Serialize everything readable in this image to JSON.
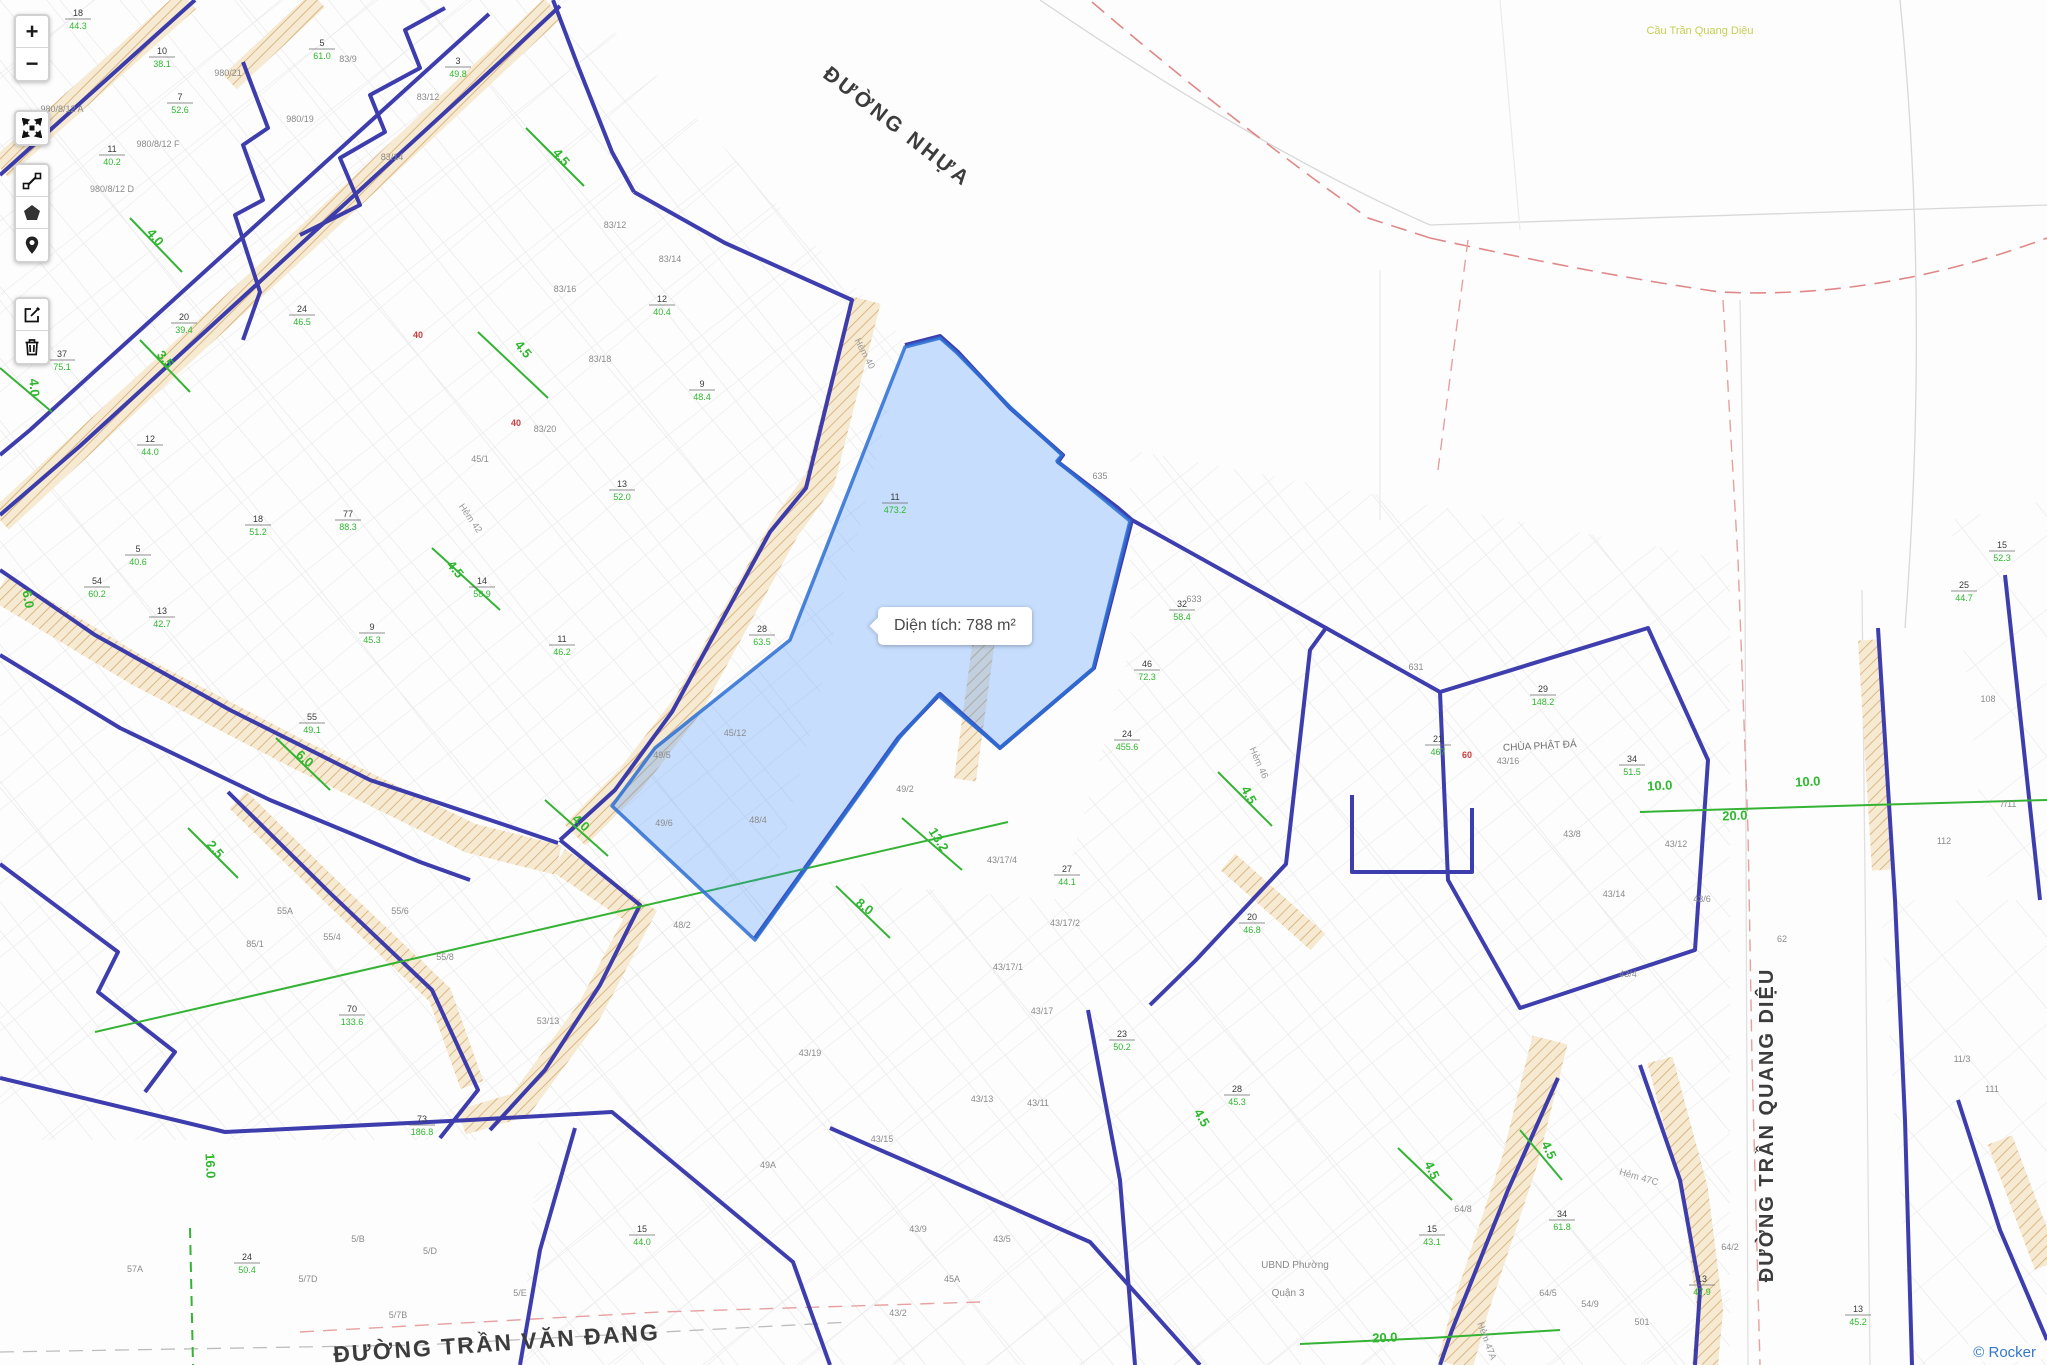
{
  "attribution": {
    "label": "© Rocker"
  },
  "toolbar": {
    "zoom_in": "+",
    "zoom_out": "−",
    "tools": [
      "fullscreen",
      "measure",
      "polygon",
      "marker",
      "edit",
      "delete"
    ]
  },
  "tooltip": {
    "text": "Diện tích: 788 m²"
  },
  "colors": {
    "boundary_navy": "#2f2fa8",
    "selection_fill": "#3388ff",
    "selection_stroke": "#2b6fd4",
    "dimension_green": "#2eb82e",
    "road_hatch_tan": "#d7b27e",
    "red_dashed": "#e08888",
    "attribution_blue": "#3478c8"
  },
  "map": {
    "streets": [
      {
        "t": "ĐƯỜNG NHỰA",
        "x": 893,
        "y": 132,
        "r": 38,
        "s": 21,
        "ls": 3
      },
      {
        "t": "ĐƯỜNG TRẦN QUANG DIỆU",
        "x": 1773,
        "y": 1125,
        "r": -90,
        "s": 20,
        "ls": 2
      },
      {
        "t": "ĐƯỜNG TRẦN VĂN ĐANG",
        "x": 497,
        "y": 1351,
        "r": -4,
        "s": 23,
        "ls": 2
      }
    ],
    "poi": [
      {
        "t": "Cầu Trần Quang Diệu",
        "x": 1700,
        "y": 34,
        "s": 11,
        "c": "#c6cf52"
      },
      {
        "t": "CHÙA PHẬT ĐÁ",
        "x": 1540,
        "y": 749,
        "s": 10,
        "c": "#6f6f6f",
        "r": -3
      },
      {
        "t": "UBND Phường",
        "x": 1295,
        "y": 1268,
        "s": 10,
        "c": "#8a8a8a"
      },
      {
        "t": "Quận 3",
        "x": 1288,
        "y": 1296,
        "s": 10,
        "c": "#8a8a8a"
      }
    ],
    "hems": [
      {
        "t": "Hẻm 40",
        "x": 862,
        "y": 355,
        "r": 62
      },
      {
        "t": "Hẻm 46",
        "x": 1256,
        "y": 764,
        "r": 66
      },
      {
        "t": "Hẻm 47C",
        "x": 1638,
        "y": 1180,
        "r": 16
      },
      {
        "t": "Hẻm 47A",
        "x": 1484,
        "y": 1342,
        "r": 70
      },
      {
        "t": "Hẻm 42",
        "x": 468,
        "y": 520,
        "r": 55
      }
    ],
    "dims": [
      {
        "t": "4.5",
        "x": 558,
        "y": 160,
        "r": 50
      },
      {
        "t": "4.5",
        "x": 520,
        "y": 352,
        "r": 50
      },
      {
        "t": "4.5",
        "x": 452,
        "y": 572,
        "r": 50
      },
      {
        "t": "4.0",
        "x": 152,
        "y": 240,
        "r": 50
      },
      {
        "t": "4.0",
        "x": 30,
        "y": 388,
        "r": 85
      },
      {
        "t": "4.0",
        "x": 578,
        "y": 826,
        "r": 42
      },
      {
        "t": "3.5",
        "x": 162,
        "y": 362,
        "r": 50
      },
      {
        "t": "6.0",
        "x": 24,
        "y": 600,
        "r": 80
      },
      {
        "t": "6.0",
        "x": 302,
        "y": 762,
        "r": 40
      },
      {
        "t": "2.5",
        "x": 212,
        "y": 852,
        "r": 50
      },
      {
        "t": "8.0",
        "x": 862,
        "y": 910,
        "r": 38
      },
      {
        "t": "13.2",
        "x": 935,
        "y": 842,
        "r": 58
      },
      {
        "t": "16.0",
        "x": 206,
        "y": 1166,
        "r": 87
      },
      {
        "t": "10.0",
        "x": 1660,
        "y": 790,
        "r": -3
      },
      {
        "t": "20.0",
        "x": 1735,
        "y": 820,
        "r": -2
      },
      {
        "t": "10.0",
        "x": 1808,
        "y": 786,
        "r": -3
      },
      {
        "t": "20.0",
        "x": 1385,
        "y": 1342,
        "r": -2
      },
      {
        "t": "4.5",
        "x": 1245,
        "y": 797,
        "r": 62
      },
      {
        "t": "4.5",
        "x": 1428,
        "y": 1172,
        "r": 65
      },
      {
        "t": "4.5",
        "x": 1198,
        "y": 1120,
        "r": 60
      },
      {
        "t": "4.5",
        "x": 1545,
        "y": 1152,
        "r": 65
      }
    ],
    "fractions": [
      {
        "x": 78,
        "y": 16,
        "a": "18",
        "b": "44.3"
      },
      {
        "x": 162,
        "y": 54,
        "a": "10",
        "b": "38.1"
      },
      {
        "x": 180,
        "y": 100,
        "a": "7",
        "b": "52.6"
      },
      {
        "x": 112,
        "y": 152,
        "a": "11",
        "b": "40.2"
      },
      {
        "x": 322,
        "y": 46,
        "a": "5",
        "b": "61.0"
      },
      {
        "x": 458,
        "y": 64,
        "a": "3",
        "b": "49.8"
      },
      {
        "x": 302,
        "y": 312,
        "a": "24",
        "b": "46.5"
      },
      {
        "x": 184,
        "y": 320,
        "a": "20",
        "b": "39.4"
      },
      {
        "x": 62,
        "y": 357,
        "a": "37",
        "b": "75.1"
      },
      {
        "x": 150,
        "y": 442,
        "a": "12",
        "b": "44.0"
      },
      {
        "x": 258,
        "y": 522,
        "a": "18",
        "b": "51.2"
      },
      {
        "x": 138,
        "y": 552,
        "a": "5",
        "b": "40.6"
      },
      {
        "x": 348,
        "y": 517,
        "a": "77",
        "b": "88.3"
      },
      {
        "x": 97,
        "y": 584,
        "a": "54",
        "b": "60.2"
      },
      {
        "x": 162,
        "y": 614,
        "a": "13",
        "b": "42.7"
      },
      {
        "x": 372,
        "y": 630,
        "a": "9",
        "b": "45.3"
      },
      {
        "x": 482,
        "y": 584,
        "a": "14",
        "b": "58.9"
      },
      {
        "x": 312,
        "y": 720,
        "a": "55",
        "b": "49.1"
      },
      {
        "x": 662,
        "y": 302,
        "a": "12",
        "b": "40.4"
      },
      {
        "x": 702,
        "y": 387,
        "a": "9",
        "b": "48.4"
      },
      {
        "x": 622,
        "y": 487,
        "a": "13",
        "b": "52.0"
      },
      {
        "x": 562,
        "y": 642,
        "a": "11",
        "b": "46.2"
      },
      {
        "x": 762,
        "y": 632,
        "a": "28",
        "b": "63.5"
      },
      {
        "x": 895,
        "y": 500,
        "a": "11",
        "b": "473.2"
      },
      {
        "x": 1182,
        "y": 607,
        "a": "32",
        "b": "58.4"
      },
      {
        "x": 1147,
        "y": 667,
        "a": "46",
        "b": "72.3"
      },
      {
        "x": 1127,
        "y": 737,
        "a": "24",
        "b": "455.6"
      },
      {
        "x": 1438,
        "y": 742,
        "a": "21",
        "b": "467"
      },
      {
        "x": 1543,
        "y": 692,
        "a": "29",
        "b": "148.2"
      },
      {
        "x": 1632,
        "y": 762,
        "a": "34",
        "b": "51.5"
      },
      {
        "x": 1252,
        "y": 920,
        "a": "20",
        "b": "46.8"
      },
      {
        "x": 1067,
        "y": 872,
        "a": "27",
        "b": "44.1"
      },
      {
        "x": 1122,
        "y": 1037,
        "a": "23",
        "b": "50.2"
      },
      {
        "x": 1237,
        "y": 1092,
        "a": "28",
        "b": "45.3"
      },
      {
        "x": 1432,
        "y": 1232,
        "a": "15",
        "b": "43.1"
      },
      {
        "x": 1562,
        "y": 1217,
        "a": "34",
        "b": "61.8"
      },
      {
        "x": 1702,
        "y": 1282,
        "a": "13",
        "b": "47.9"
      },
      {
        "x": 247,
        "y": 1260,
        "a": "24",
        "b": "50.4"
      },
      {
        "x": 352,
        "y": 1012,
        "a": "70",
        "b": "133.6"
      },
      {
        "x": 422,
        "y": 1122,
        "a": "73",
        "b": "186.8"
      },
      {
        "x": 642,
        "y": 1232,
        "a": "15",
        "b": "44.0"
      },
      {
        "x": 2002,
        "y": 548,
        "a": "15",
        "b": "52.3"
      },
      {
        "x": 1964,
        "y": 588,
        "a": "25",
        "b": "44.7"
      },
      {
        "x": 1858,
        "y": 1312,
        "a": "13",
        "b": "45.2"
      }
    ],
    "houses": [
      {
        "x": 62,
        "y": 112,
        "t": "980/8/12 A"
      },
      {
        "x": 158,
        "y": 147,
        "t": "980/8/12 F"
      },
      {
        "x": 112,
        "y": 192,
        "t": "980/8/12 D"
      },
      {
        "x": 300,
        "y": 122,
        "t": "980/19"
      },
      {
        "x": 228,
        "y": 76,
        "t": "980/21"
      },
      {
        "x": 348,
        "y": 62,
        "t": "83/9"
      },
      {
        "x": 428,
        "y": 100,
        "t": "83/12"
      },
      {
        "x": 392,
        "y": 160,
        "t": "83/14"
      },
      {
        "x": 565,
        "y": 292,
        "t": "83/16"
      },
      {
        "x": 615,
        "y": 228,
        "t": "83/12"
      },
      {
        "x": 670,
        "y": 262,
        "t": "83/14"
      },
      {
        "x": 600,
        "y": 362,
        "t": "83/18"
      },
      {
        "x": 545,
        "y": 432,
        "t": "83/20"
      },
      {
        "x": 480,
        "y": 462,
        "t": "45/1"
      },
      {
        "x": 735,
        "y": 736,
        "t": "45/12"
      },
      {
        "x": 662,
        "y": 758,
        "t": "49/5"
      },
      {
        "x": 664,
        "y": 826,
        "t": "49/6"
      },
      {
        "x": 758,
        "y": 823,
        "t": "48/4"
      },
      {
        "x": 905,
        "y": 792,
        "t": "49/2"
      },
      {
        "x": 1002,
        "y": 863,
        "t": "43/17/4"
      },
      {
        "x": 1065,
        "y": 926,
        "t": "43/17/2"
      },
      {
        "x": 1008,
        "y": 970,
        "t": "43/17/1"
      },
      {
        "x": 1042,
        "y": 1014,
        "t": "43/17"
      },
      {
        "x": 982,
        "y": 1102,
        "t": "43/13"
      },
      {
        "x": 1038,
        "y": 1106,
        "t": "43/11"
      },
      {
        "x": 918,
        "y": 1232,
        "t": "43/9"
      },
      {
        "x": 1002,
        "y": 1242,
        "t": "43/5"
      },
      {
        "x": 952,
        "y": 1282,
        "t": "45A"
      },
      {
        "x": 898,
        "y": 1316,
        "t": "43/2"
      },
      {
        "x": 768,
        "y": 1168,
        "t": "49A"
      },
      {
        "x": 548,
        "y": 1024,
        "t": "53/13"
      },
      {
        "x": 445,
        "y": 960,
        "t": "55/8"
      },
      {
        "x": 400,
        "y": 914,
        "t": "55/6"
      },
      {
        "x": 332,
        "y": 940,
        "t": "55/4"
      },
      {
        "x": 285,
        "y": 914,
        "t": "55A"
      },
      {
        "x": 255,
        "y": 947,
        "t": "85/1"
      },
      {
        "x": 135,
        "y": 1272,
        "t": "57A"
      },
      {
        "x": 358,
        "y": 1242,
        "t": "5/B"
      },
      {
        "x": 430,
        "y": 1254,
        "t": "5/D"
      },
      {
        "x": 520,
        "y": 1296,
        "t": "5/E"
      },
      {
        "x": 398,
        "y": 1318,
        "t": "5/7B"
      },
      {
        "x": 308,
        "y": 1282,
        "t": "5/7D"
      },
      {
        "x": 1100,
        "y": 479,
        "t": "635"
      },
      {
        "x": 1194,
        "y": 602,
        "t": "633"
      },
      {
        "x": 1416,
        "y": 670,
        "t": "631"
      },
      {
        "x": 1508,
        "y": 764,
        "t": "43/16"
      },
      {
        "x": 1614,
        "y": 897,
        "t": "43/14"
      },
      {
        "x": 1676,
        "y": 847,
        "t": "43/12"
      },
      {
        "x": 1572,
        "y": 837,
        "t": "43/8"
      },
      {
        "x": 1702,
        "y": 902,
        "t": "43/6"
      },
      {
        "x": 1628,
        "y": 977,
        "t": "43/4"
      },
      {
        "x": 1782,
        "y": 942,
        "t": "62"
      },
      {
        "x": 1988,
        "y": 702,
        "t": "108"
      },
      {
        "x": 2008,
        "y": 807,
        "t": "7/11"
      },
      {
        "x": 1944,
        "y": 844,
        "t": "112"
      },
      {
        "x": 1962,
        "y": 1062,
        "t": "11/3"
      },
      {
        "x": 1992,
        "y": 1092,
        "t": "111"
      },
      {
        "x": 1463,
        "y": 1212,
        "t": "64/8"
      },
      {
        "x": 1548,
        "y": 1296,
        "t": "64/5"
      },
      {
        "x": 1590,
        "y": 1307,
        "t": "54/9"
      },
      {
        "x": 1642,
        "y": 1325,
        "t": "501"
      },
      {
        "x": 1730,
        "y": 1250,
        "t": "64/2"
      },
      {
        "x": 682,
        "y": 928,
        "t": "48/2"
      },
      {
        "x": 810,
        "y": 1056,
        "t": "43/19"
      },
      {
        "x": 882,
        "y": 1142,
        "t": "43/15"
      }
    ],
    "reds": [
      {
        "t": "60",
        "x": 1467,
        "y": 758
      },
      {
        "t": "40",
        "x": 516,
        "y": 426
      },
      {
        "t": "40",
        "x": 418,
        "y": 338
      }
    ]
  }
}
